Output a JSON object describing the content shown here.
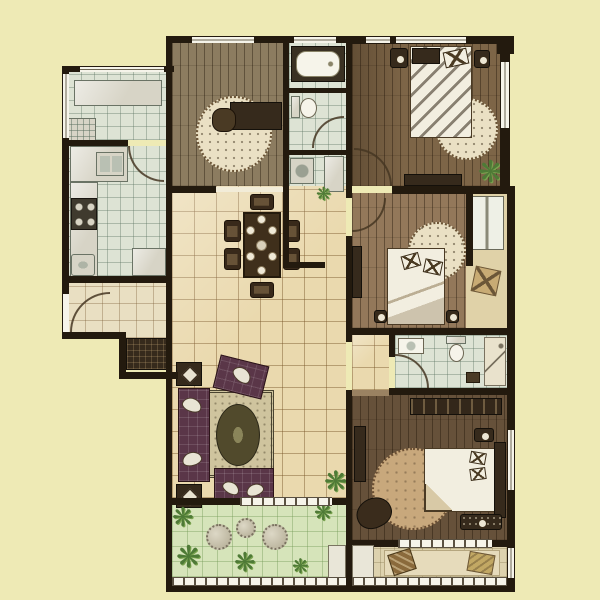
{
  "meta": {
    "kind": "apartment-floor-plan-rendering",
    "visible_text": "none"
  },
  "icons": {
    "plant_glyph": "❋"
  },
  "regions": [
    "service-balcony",
    "kitchen",
    "entry",
    "study",
    "bathroom-main",
    "laundry",
    "bedroom-top-right",
    "bedroom-middle-right",
    "utility-shaft",
    "bathroom-second",
    "hall-dining",
    "living-room",
    "corridor",
    "master-bedroom",
    "garden-balcony",
    "master-balcony"
  ],
  "furniture": [
    "washing-machine",
    "kitchen-sink",
    "stove",
    "bathtub",
    "toilet",
    "double-bed",
    "nightstand",
    "round-rug",
    "dining-table",
    "dining-chairs",
    "sofa-set",
    "coffee-rug",
    "wardrobe",
    "armchair",
    "shower",
    "washbasin",
    "stepping-stones",
    "plants",
    "cushions"
  ],
  "colors": {
    "bg": "#eeeab5",
    "wall": "#231a0e",
    "wood-study": "#8c7c60",
    "wood-tr": "#7d6547",
    "wood-mr": "#93785a",
    "wood-master": "#66513a",
    "tile-hall": "#ead9ae",
    "tile-cool": "#dde3d4",
    "entry-floor": "#e9dfc2",
    "garden": "#d6e4ba",
    "balc-master": "#ddd2ae",
    "shaft-floor": "#e0d2a8",
    "plant": "#4e7a36",
    "plant-light": "#7aa34f",
    "rug": "#eae0c4",
    "rug-line": "#6b5436",
    "sofa": "#5a3648",
    "sofa-cushion": "#e8e4d4",
    "bed": "#f2eee0",
    "furn-dark": "#362a1c",
    "counter": "#d7d4c6",
    "counter-line": "#6a7365",
    "window": "#f6f4ea",
    "rug-rect": "#cfc49e",
    "rug-oval": "#514a2c",
    "master-rug": "#c8a87c",
    "basket": "#c8ab74"
  }
}
